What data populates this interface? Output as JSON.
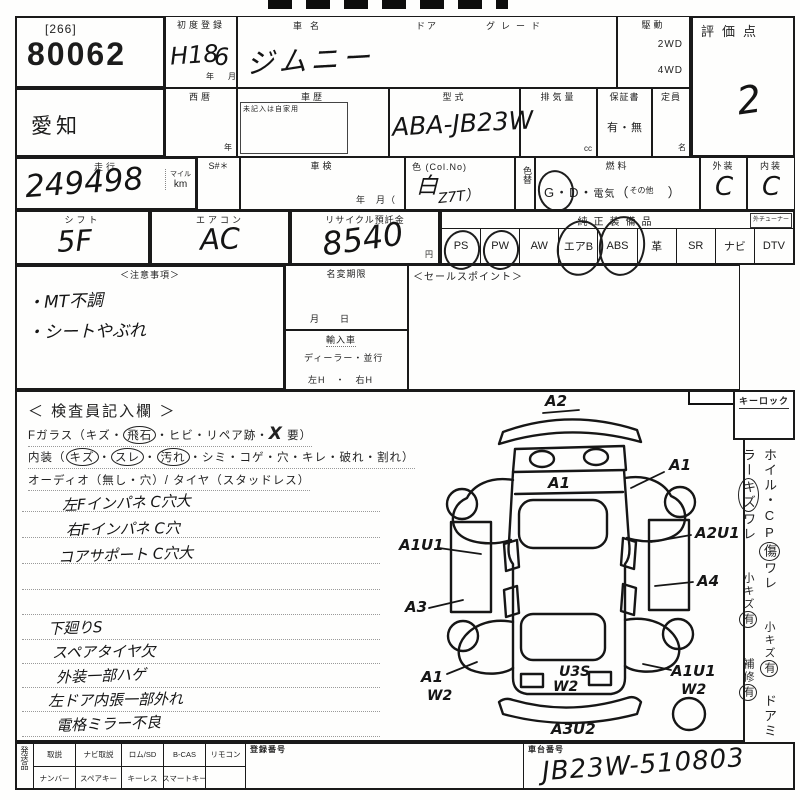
{
  "lot": {
    "bracket": "[266]",
    "number": "80062"
  },
  "reg": {
    "label": "初度登録",
    "year": "H18",
    "year_u": "年",
    "month": "6",
    "month_u": "月"
  },
  "name": {
    "label": "車名",
    "value": "ジムニー",
    "door_label": "ドア",
    "grade_label": "グレード"
  },
  "drive": {
    "label": "駆動",
    "opt1": "2WD",
    "opt2": "4WD"
  },
  "score": {
    "label": "評価点",
    "value": "2"
  },
  "r2": {
    "pref": "愛知",
    "seireki": "西暦",
    "year_u": "年",
    "history": "車歴",
    "history_note": "未記入は自家用",
    "model": "型式",
    "model_value": "ABA-JB23W",
    "disp": "排気量",
    "cc": "cc",
    "warranty": "保証書",
    "warranty_value": "有・無",
    "cap": "定員",
    "cap_u": "名"
  },
  "r3": {
    "run": "走行",
    "run_value": "249498",
    "mile": "マイル",
    "km": "km",
    "s": "S#＊",
    "shaken": "車検",
    "shaken_u": "年　月（",
    "color": "色 (Col.No)",
    "color_value": "白",
    "color_code": "Z7T）",
    "colorchg": "色替",
    "fuel": "燃料",
    "g": "G",
    "dot": "・",
    "d": "D",
    "elec": "電気",
    "par_open": "（",
    "other": "その他",
    "par_close": "）",
    "ext": "外装",
    "ext_v": "C",
    "int": "内装",
    "int_v": "C"
  },
  "r4": {
    "shift": "シフト",
    "shift_v": "5F",
    "ac": "エアコン",
    "ac_v": "AC",
    "recycle": "リサイクル預託金",
    "recycle_v": "8540",
    "yen": "円",
    "equip": "純正装備品",
    "tuner": "外チューナー",
    "items": [
      {
        "label": "PS",
        "circled": true
      },
      {
        "label": "PW",
        "circled": true
      },
      {
        "label": "AW",
        "circled": false
      },
      {
        "label": "エアB",
        "circled": true
      },
      {
        "label": "ABS",
        "circled": true
      },
      {
        "label": "革",
        "circled": false
      },
      {
        "label": "SR",
        "circled": false
      },
      {
        "label": "ナビ",
        "circled": false
      },
      {
        "label": "DTV",
        "circled": false
      }
    ]
  },
  "mid": {
    "caution": "＜注意事項＞",
    "c1": "・MT不調",
    "c2": "・シートやぶれ",
    "namechg": "名変期限",
    "md": "月　　日",
    "import": "輸入車",
    "dealer": "ディーラー・並行",
    "handle": "左H　・　右H",
    "sales": "＜セールスポイント＞"
  },
  "insp": {
    "title": "＜ 検査員記入欄 ＞",
    "fg_pre": "Fガラス（キズ・",
    "fg_c": "飛石",
    "fg_mid": "・ヒビ・リペア跡・",
    "fg_x": "X",
    "fg_suf": "要）",
    "in_pre": "内装（",
    "in_c1": "キズ",
    "in_c2": "スレ",
    "in_c3": "汚れ",
    "dot": "・",
    "in_suf": "・シミ・コゲ・穴・キレ・破れ・割れ）",
    "audio": "オーディオ（無し・穴）/ タイヤ（スタッドレス）",
    "n1": "左Fインパネ C穴大",
    "n2": "右Fインパネ C穴",
    "n3": "コアサポート C穴大",
    "n4": "下廻りS",
    "n5": "スペアタイヤ欠",
    "n6": "外装一部ハゲ",
    "n7": "左ドア内張一部外れ",
    "n8": "電格ミラー不良"
  },
  "diag": {
    "a2": "A2",
    "a1_hood": "A1",
    "a1_rf": "A1",
    "a1u1_lf": "A1U1",
    "a2u1": "A2U1",
    "a3": "A3",
    "a4": "A4",
    "a1_lr": "A1",
    "w2_lr": "W2",
    "u3s": "U3S",
    "w2_gate": "W2",
    "a1u1_rr": "A1U1",
    "w2_spare": "W2",
    "a3u2": "A3U2"
  },
  "side": {
    "keylock": "キーロック",
    "v1a": "ホイル・CP",
    "v1b": "傷",
    "v1c": "ワレ",
    "v2a": "小キズ",
    "v2b": "有",
    "v3a": "ドアミラー",
    "v3b": "キズ",
    "v3c": "ワレ",
    "v4a": "小キズ",
    "v4b": "有",
    "v5a": "補修",
    "v5b": "有"
  },
  "foot": {
    "ship": "発送品",
    "g1": [
      "取説",
      "ナビ取説",
      "ロム/SD",
      "B-CAS",
      "リモコン"
    ],
    "g2": [
      "ナンバー",
      "スペアキー",
      "キーレス",
      "スマートキー"
    ],
    "reg": "登録番号",
    "chassis": "車台番号",
    "chassis_v": "JB23W-510803"
  }
}
